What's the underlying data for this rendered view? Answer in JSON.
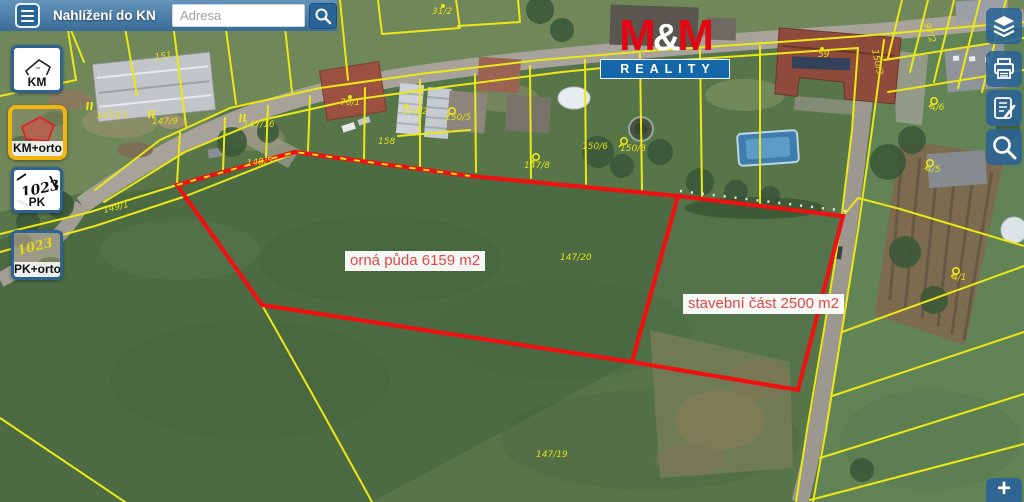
{
  "header": {
    "title": "Nahlížení do KN",
    "search": {
      "placeholder": "Adresa"
    }
  },
  "sidebar": {
    "items": [
      {
        "id": "km",
        "label": "KM",
        "active": false
      },
      {
        "id": "km-orto",
        "label": "KM+orto",
        "active": true
      },
      {
        "id": "pk",
        "label": "PK",
        "active": false,
        "icon_text": "1023"
      },
      {
        "id": "pk-orto",
        "label": "PK+orto",
        "active": false,
        "icon_text": "1023"
      }
    ]
  },
  "right_toolbar": {
    "buttons": [
      {
        "id": "layers",
        "icon": "layers-icon"
      },
      {
        "id": "print",
        "icon": "printer-icon"
      },
      {
        "id": "report",
        "icon": "report-edit-icon"
      },
      {
        "id": "search",
        "icon": "search-icon"
      }
    ]
  },
  "zoom_control": {
    "plus": "+"
  },
  "watermark": {
    "m1": "M",
    "amp": "&",
    "m2": "M",
    "word": "REALITY",
    "red": "#e30613",
    "blue": "#1467a8"
  },
  "map": {
    "area_labels": [
      {
        "id": "orna-puda",
        "text": "orná půda 6159 m2"
      },
      {
        "id": "stavebni-cast",
        "text": "stavební část 2500 m2"
      }
    ],
    "parcel_labels": [
      {
        "text": "151",
        "x": 155,
        "y": 60,
        "rot": -8
      },
      {
        "text": "147/13",
        "x": 96,
        "y": 118,
        "rot": 0
      },
      {
        "text": "147/9",
        "x": 152,
        "y": 124,
        "rot": 0
      },
      {
        "text": "147/16",
        "x": 243,
        "y": 127,
        "rot": 0
      },
      {
        "text": "148/5",
        "x": 247,
        "y": 166,
        "rot": -6
      },
      {
        "text": "149/1",
        "x": 104,
        "y": 213,
        "rot": -14
      },
      {
        "text": "31/2",
        "x": 432,
        "y": 14,
        "rot": 0
      },
      {
        "text": "70/1",
        "x": 340,
        "y": 105,
        "rot": 0
      },
      {
        "text": "150/2",
        "x": 402,
        "y": 114,
        "rot": 0
      },
      {
        "text": "150/5",
        "x": 445,
        "y": 120,
        "rot": 0
      },
      {
        "text": "158",
        "x": 378,
        "y": 144,
        "rot": 0
      },
      {
        "text": "147/8",
        "x": 524,
        "y": 168,
        "rot": 0
      },
      {
        "text": "150/6",
        "x": 582,
        "y": 149,
        "rot": 0
      },
      {
        "text": "150/8",
        "x": 620,
        "y": 151,
        "rot": 0
      },
      {
        "text": "147/20",
        "x": 560,
        "y": 260,
        "rot": 0
      },
      {
        "text": "147/19",
        "x": 536,
        "y": 457,
        "rot": 0
      },
      {
        "text": "59",
        "x": 818,
        "y": 57,
        "rot": 0
      },
      {
        "text": "150/3",
        "x": 872,
        "y": 50,
        "rot": 78
      },
      {
        "text": "97/2",
        "x": 924,
        "y": 24,
        "rot": 72
      },
      {
        "text": "4/6",
        "x": 930,
        "y": 110,
        "rot": 0
      },
      {
        "text": "4/5",
        "x": 926,
        "y": 172,
        "rot": 0
      },
      {
        "text": "4/1",
        "x": 952,
        "y": 280,
        "rot": 0
      }
    ],
    "symbols": [
      {
        "type": "flag",
        "x": 536,
        "y": 157
      },
      {
        "type": "flag",
        "x": 624,
        "y": 141
      },
      {
        "type": "flag",
        "x": 452,
        "y": 111
      },
      {
        "type": "flag",
        "x": 934,
        "y": 101
      },
      {
        "type": "flag",
        "x": 930,
        "y": 163
      },
      {
        "type": "flag",
        "x": 956,
        "y": 271
      },
      {
        "type": "dot",
        "x": 350,
        "y": 97
      },
      {
        "type": "dot",
        "x": 822,
        "y": 49
      },
      {
        "type": "dot",
        "x": 443,
        "y": 6
      },
      {
        "type": "dot",
        "x": 406,
        "y": 106
      },
      {
        "type": "ticks",
        "x": 88,
        "y": 106
      },
      {
        "type": "ticks",
        "x": 150,
        "y": 114
      },
      {
        "type": "ticks",
        "x": 241,
        "y": 118
      }
    ],
    "colors": {
      "parcel_line": "#ece818",
      "highlight": "#ee1111",
      "area_label_text": "#e04848"
    }
  }
}
